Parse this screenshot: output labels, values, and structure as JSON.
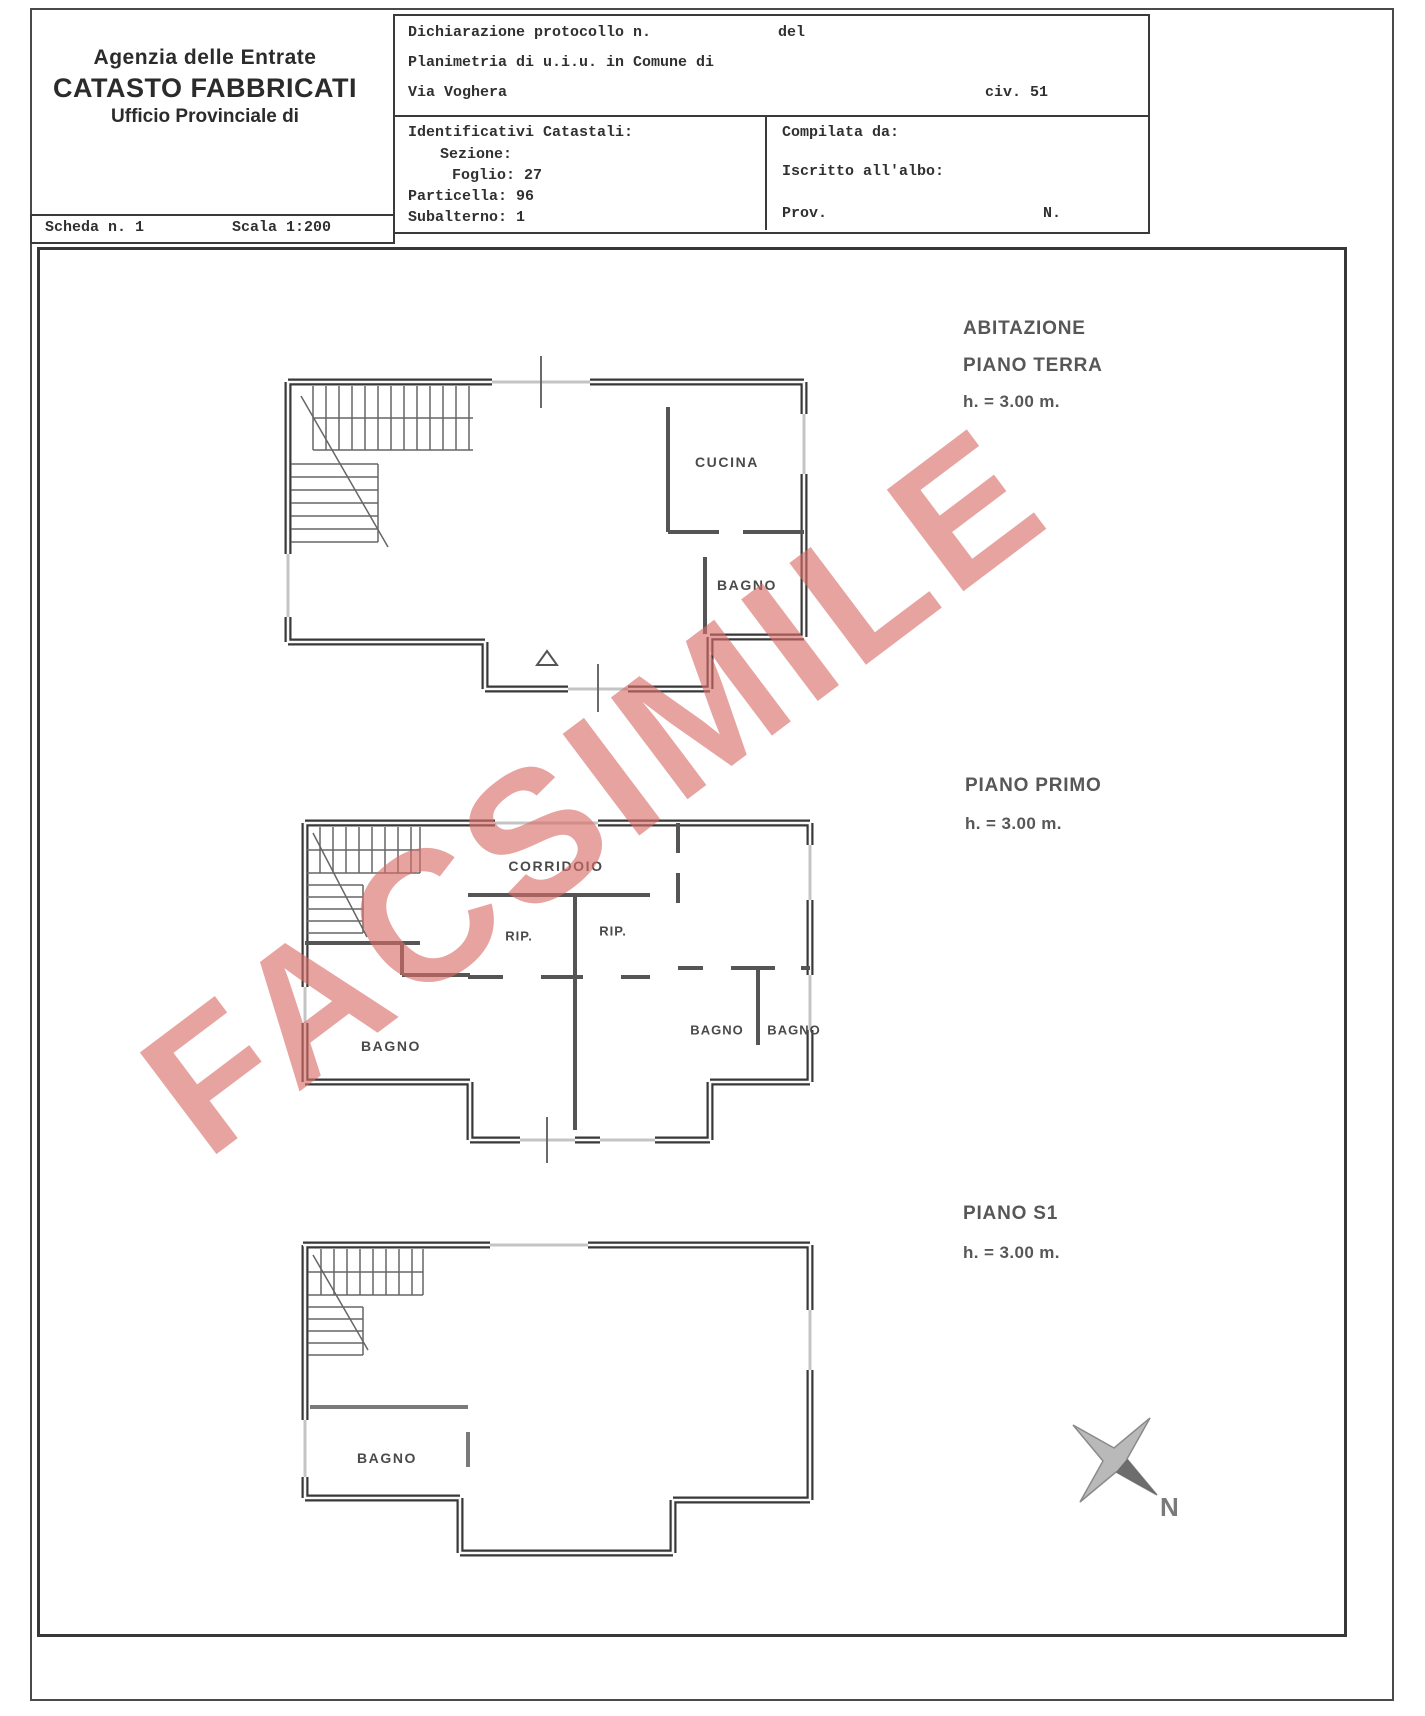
{
  "document": {
    "agency": {
      "line1": "Agenzia delle Entrate",
      "line2": "CATASTO FABBRICATI",
      "line3": "Ufficio Provinciale di"
    },
    "protocol_box": {
      "dichiarazione": "Dichiarazione protocollo n.",
      "del": "del",
      "planimetria": "Planimetria di u.i.u. in Comune di",
      "via": "Via Voghera",
      "civ": "civ. 51"
    },
    "identificativi": {
      "title": "Identificativi Catastali:",
      "sezione": "Sezione:",
      "foglio": "Foglio: 27",
      "particella": "Particella: 96",
      "subalterno": "Subalterno: 1"
    },
    "compilata": {
      "compilata_da": "Compilata da:",
      "iscritto": "Iscritto all'albo:",
      "prov": "Prov.",
      "n": "N."
    },
    "scheda": {
      "numero": "Scheda n. 1",
      "scala": "Scala 1:200"
    }
  },
  "plans": {
    "terra": {
      "title": "ABITAZIONE",
      "subtitle": "PIANO TERRA",
      "height": "h. = 3.00 m.",
      "room_cucina": "CUCINA",
      "room_bagno": "BAGNO"
    },
    "primo": {
      "title": "PIANO PRIMO",
      "height": "h. = 3.00 m.",
      "room_corridoio": "CORRIDOIO",
      "room_rip1": "RIP.",
      "room_rip2": "RIP.",
      "room_bagno_left": "BAGNO",
      "room_bagno_mid": "BAGNO",
      "room_bagno_right": "BAGNO"
    },
    "s1": {
      "title": "PIANO S1",
      "height": "h. = 3.00 m.",
      "room_bagno": "BAGNO"
    }
  },
  "watermark": {
    "text": "FACSIMILE",
    "color_hex": "#d96c66"
  },
  "compass": {
    "north_label": "N"
  }
}
